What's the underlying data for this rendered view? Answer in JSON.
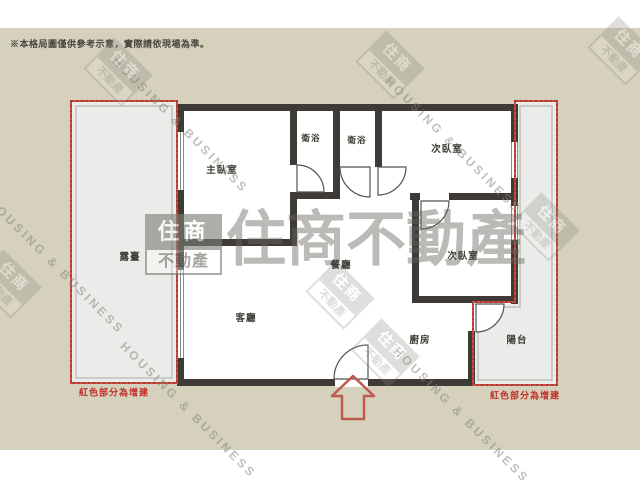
{
  "disclaimer": "※本格局圖僅供參考示意，實際請依現場為準。",
  "brand": {
    "logo_top": "住商",
    "logo_bottom": "不動產",
    "wordmark": "住商不動產",
    "wordmark_en": "HOUSING & BUSINESS"
  },
  "rooms": {
    "master": "主臥室",
    "bath1": "衛浴",
    "bath2": "衛浴",
    "bedroom_top_right": "次臥室",
    "bedroom_mid_right": "次臥室",
    "dining": "餐廳",
    "living": "客廳",
    "kitchen": "廚房",
    "balcony": "陽台",
    "terrace": "露臺"
  },
  "notes": {
    "addition_left": "紅色部分為增建",
    "addition_right": "紅色部分為增建"
  },
  "colors": {
    "background": "#d5d1bc",
    "wall": "#3e3a36",
    "addition_red": "#c84b40",
    "note_red": "#c03028",
    "watermark_gray": "#85847c",
    "floor_gray": "#ebebe9"
  }
}
